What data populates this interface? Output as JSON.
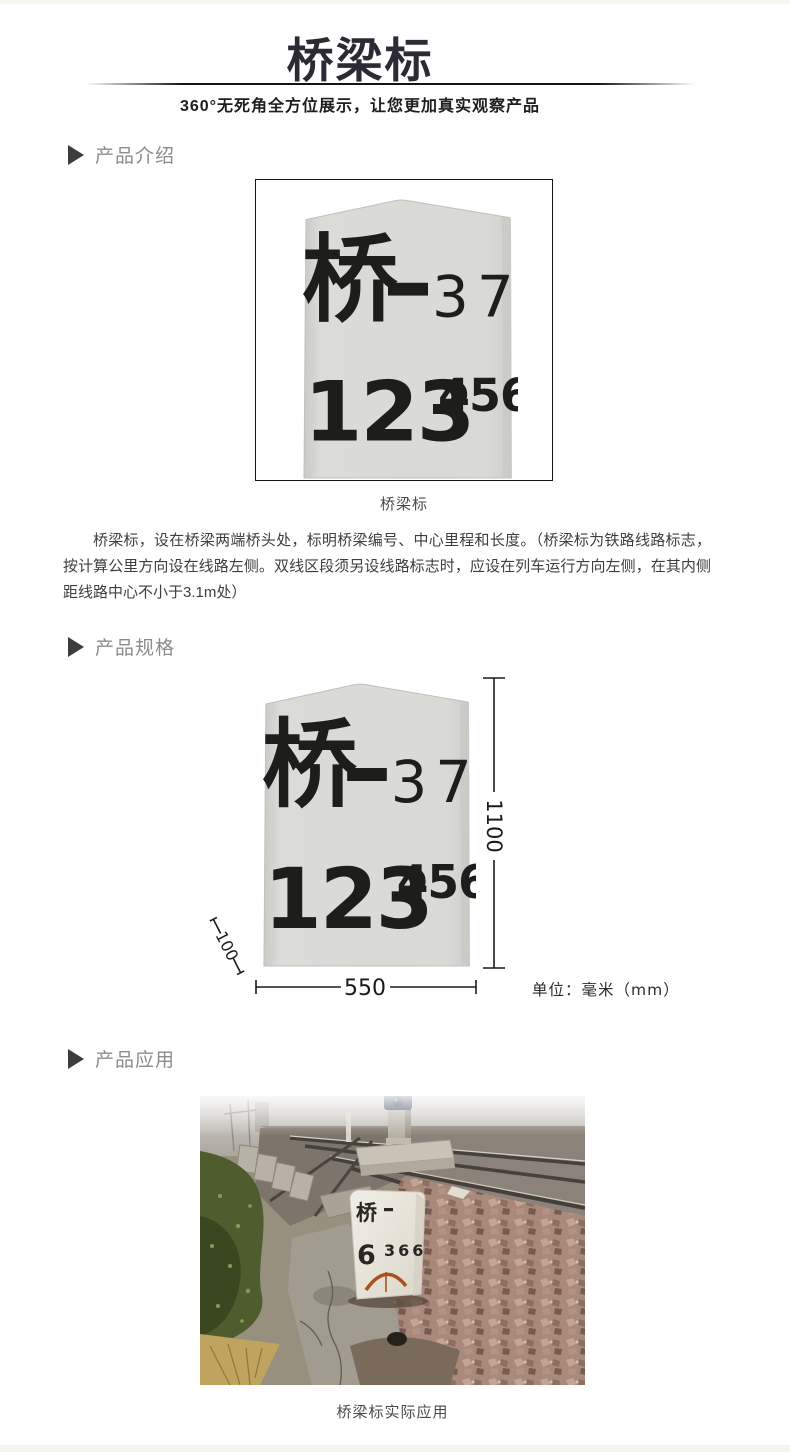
{
  "page": {
    "width": 790,
    "height": 1452,
    "background": "#ffffff",
    "edge_strip_color": "#f8f6f1"
  },
  "header": {
    "title": "桥梁标",
    "subtitle": "360°无死角全方位展示，让您更加真实观察产品",
    "title_color": "#2b2b34",
    "divider_color": "#141414"
  },
  "sections": {
    "intro_label": "产品介绍",
    "specs_label": "产品规格",
    "application_label": "产品应用",
    "label_color": "#8c8c8c",
    "arrow_color": "#3d3d3d"
  },
  "marker_stone": {
    "line1_char": "桥",
    "line1_dash": "—",
    "line1_number": "37",
    "line2_number": "123",
    "line2_superscript": "456",
    "body_color": "#d9d9d6",
    "ink_color": "#1d1d1b"
  },
  "intro": {
    "caption": "桥梁标",
    "description": "桥梁标，设在桥梁两端桥头处，标明桥梁编号、中心里程和长度。（桥梁标为铁路线路标志，按计算公里方向设在线路左侧。双线区段须另设线路标志时，应设在列车运行方向左侧，在其内侧距线路中心不小于3.1m处）"
  },
  "specs": {
    "height_mm": "1100",
    "width_mm": "550",
    "depth_mm": "100",
    "unit_label": "单位：毫米（mm）"
  },
  "application": {
    "caption": "桥梁标实际应用",
    "photo_stone_char": "桥",
    "photo_stone_dash": "-",
    "photo_stone_line2_left": "6",
    "photo_stone_line2_right": "366"
  }
}
